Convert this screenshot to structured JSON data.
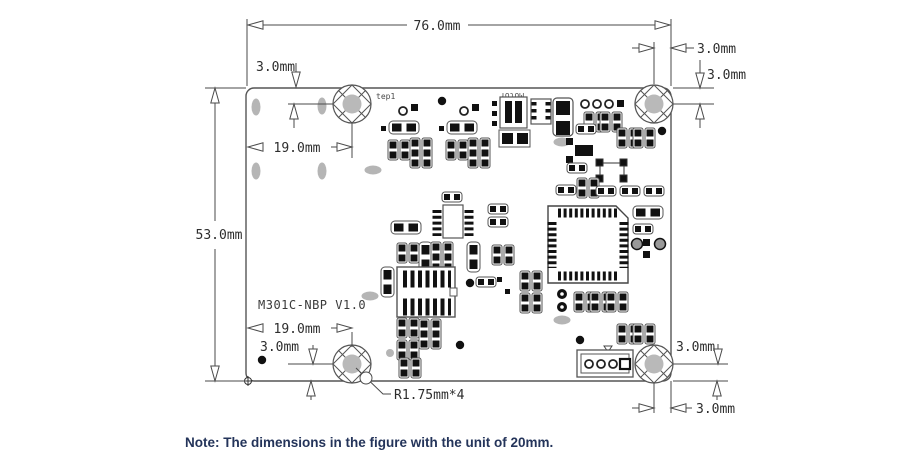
{
  "dimensions": {
    "board_width": "76.0mm",
    "board_height": "53.0mm",
    "hole_tl_x": "19.0mm",
    "hole_tl_y": "3.0mm",
    "hole_tr_x": "3.0mm",
    "hole_tr_y": "3.0mm",
    "hole_bl_x": "19.0mm",
    "hole_bl_y": "3.0mm",
    "hole_br_y": "3.0mm",
    "hole_br_x": "3.0mm",
    "hole_radius": "R1.75mm*4"
  },
  "board": {
    "name": "M301C-NBP V1.0",
    "silkscreen_test_point": "tep1",
    "silkscreen_motor": "Motor"
  },
  "note": {
    "text": "Note: The dimensions in the figure with the unit of 20mm."
  },
  "colors": {
    "line": "#4a4a4a",
    "pad": "#111111",
    "hole_fill": "#b9b9b9",
    "note_text": "#24345a"
  }
}
